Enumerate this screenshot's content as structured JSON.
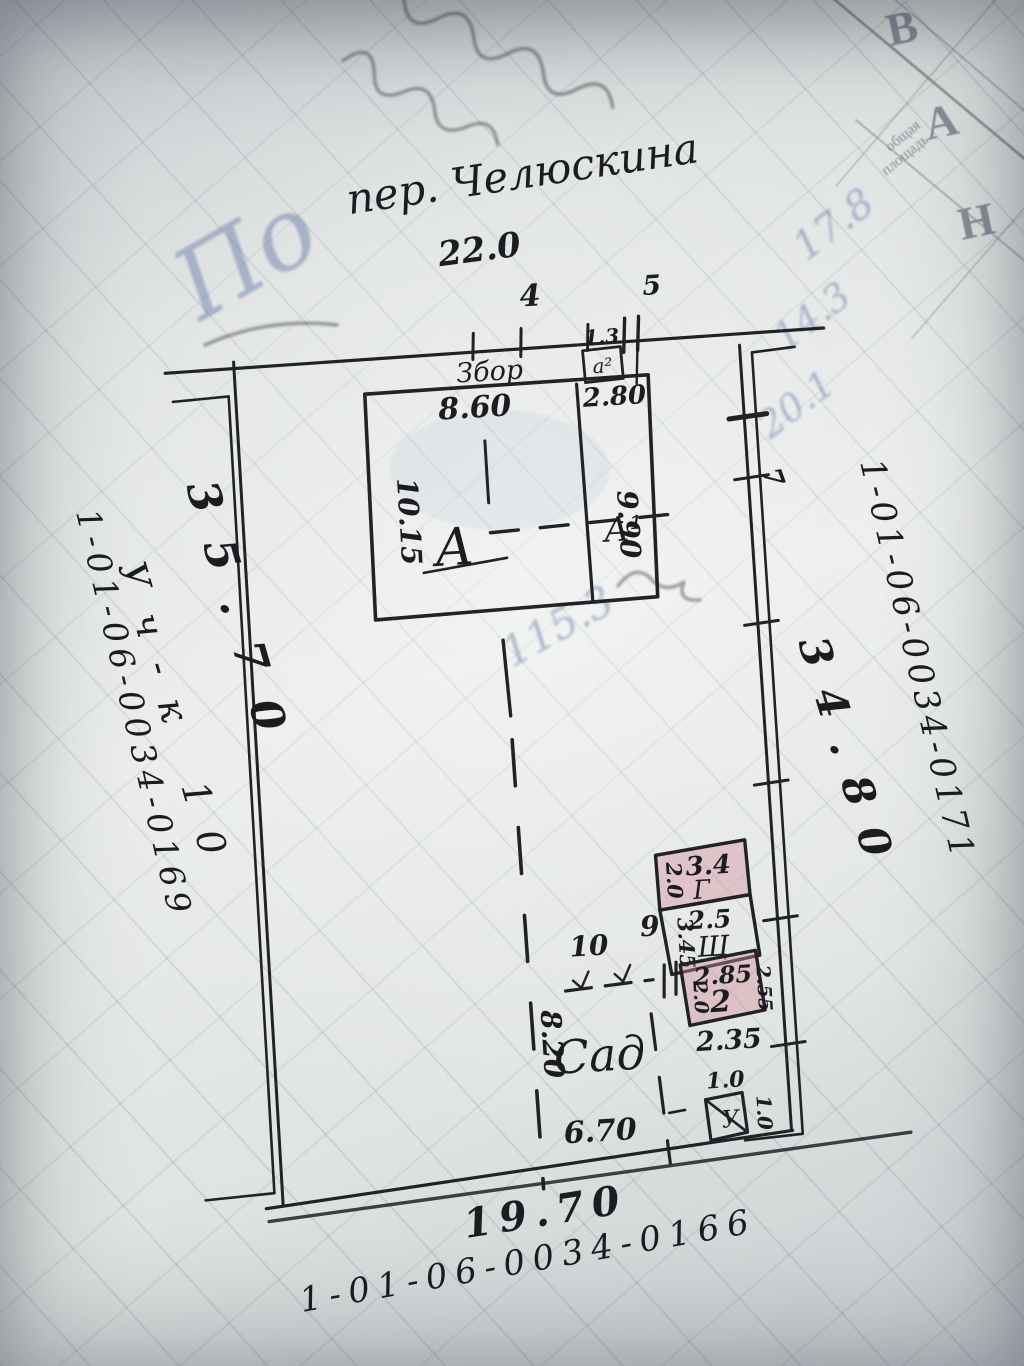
{
  "street": {
    "name": "пер. Челюскина"
  },
  "boundary": {
    "top_length": "22.0",
    "bottom_length": "19.70",
    "left_length": "35.70",
    "right_length": "34.80",
    "right_point": "7",
    "gate_left": "4",
    "gate_right": "5",
    "fence": "Збор"
  },
  "cadastral": {
    "left": "1-01-06-0034-0169",
    "right": "1-01-06-0034-0171",
    "bottom": "1-01-06-0034-0166",
    "plot_no": "Уч-к 10"
  },
  "house": {
    "width_main": "8.60",
    "width_annex": "2.80",
    "depth_left": "10.15",
    "depth_right": "9.90",
    "section_start": "А",
    "section_end": "А¹",
    "porch_width": "1.3",
    "porch_label": "а²"
  },
  "yard": {
    "divider_left": "10",
    "divider_right": "9",
    "garden_label": "Сад",
    "garden_depth": "8.20",
    "garden_width": "6.70"
  },
  "outbuildings": {
    "b1": {
      "label": "Г",
      "top": "3.4",
      "side": "2.0"
    },
    "b2": {
      "label": "Щ",
      "top": "2.5",
      "side": "3.45"
    },
    "b3": {
      "label": "2",
      "top": "2.85",
      "left": "2.0",
      "right": "2.55",
      "bottom": "2.35"
    },
    "toilet": {
      "label": "У",
      "top": "1.0",
      "side": "1.0"
    }
  },
  "bleedthrough": {
    "word": "По",
    "n1": "17.8",
    "n2": "14.3",
    "n3": "20.1",
    "n4": "115.3",
    "letter1": "В",
    "letter2": "А",
    "letter3": "Н",
    "caption1": "общая",
    "caption2": "площадь"
  },
  "colors": {
    "ink": "#1b1c20",
    "red_boundary": "#9c2333",
    "green_boundary": "#1e7a52",
    "blue_street_line": "#41629e",
    "pink_building": "#d68ca0",
    "bleed_blue": "#57699f"
  }
}
